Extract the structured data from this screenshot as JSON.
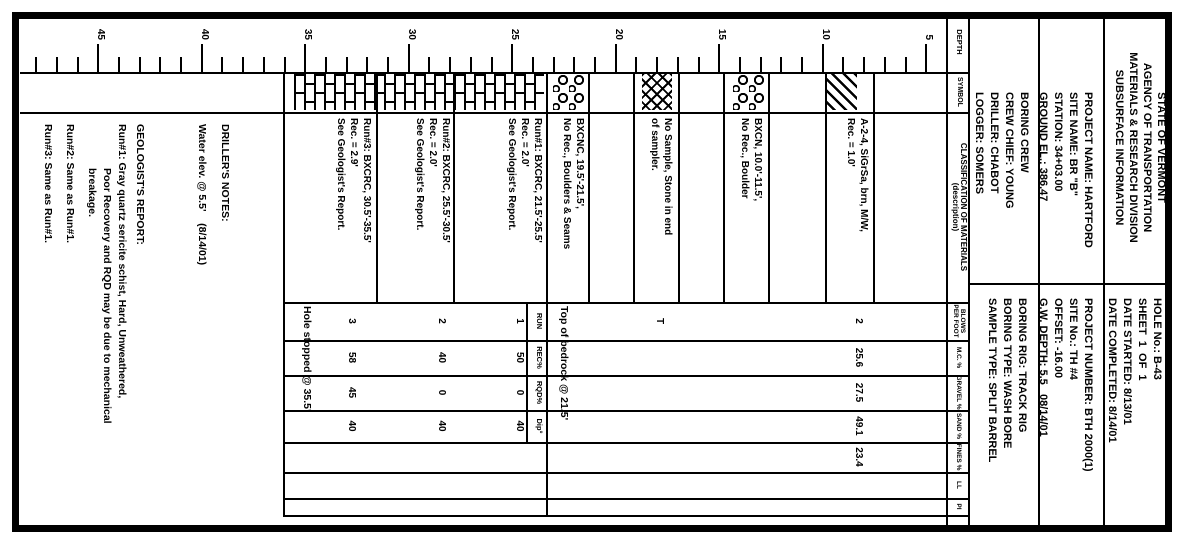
{
  "colors": {
    "ink": "#000000",
    "paper": "#ffffff"
  },
  "header": {
    "title_lines": [
      "STATE OF VERMONT",
      "AGENCY OF TRANSPORTATION",
      "MATERIALS & RESEARCH DIVISION",
      "SUBSURFACE INFORMATION"
    ],
    "hole_lines": [
      "HOLE No.: B-43",
      "SHEET  1  OF  1",
      "DATE STARTED: 8/13/01",
      "DATE COMPLETED: 8/14/01"
    ],
    "project_left_lines": [
      "PROJECT NAME: HARTFORD",
      "SITE NAME: BR \"B\"",
      "STATION: 34+03.00",
      "GROUND EL.: 386.47"
    ],
    "project_right_lines": [
      "PROJECT NUMBER: BTH 2000(1)",
      "SITE No.: TH #4",
      "OFFSET: -16.00",
      "G.W. DEPTH: 5.5   08/14/01"
    ],
    "crew_left_lines": [
      "BORING CREW",
      "CREW CHIEF: YOUNG",
      "DRILLER: CHABOT",
      "LOGGER: SOMERS"
    ],
    "crew_right_lines": [
      "BORING RIG: TRACK RIG",
      "BORING TYPE: WASH BORE",
      "SAMPLE TYPE: SPLIT BARREL"
    ]
  },
  "columns": {
    "depth": "DEPTH",
    "symbol": "SYMBOL",
    "classification": "CLASSIFICATION OF MATERIALS",
    "classification_sub": "(description)",
    "data": [
      "BLOWS PER FOOT",
      "M.C. %",
      "GRAVEL %",
      "SAND %",
      "FINES %",
      "LL",
      "PI"
    ]
  },
  "log": {
    "depth_scale": {
      "min": 4,
      "max": 48,
      "top": 236,
      "bottom": 1158,
      "px_per_ft": 20.7,
      "major_every": 5,
      "label_min": 5,
      "label_max": 45
    },
    "data_columns": [
      {
        "x": 302,
        "w": 38
      },
      {
        "x": 340,
        "w": 35
      },
      {
        "x": 375,
        "w": 35
      },
      {
        "x": 410,
        "w": 32
      },
      {
        "x": 442,
        "w": 30
      },
      {
        "x": 472,
        "w": 26
      },
      {
        "x": 498,
        "w": 17
      }
    ],
    "lines": [
      {
        "x": 283,
        "y": 12,
        "w": 2,
        "h": 202
      },
      {
        "x": 12,
        "y": 79,
        "w": 520,
        "h": 2
      },
      {
        "x": 12,
        "y": 144,
        "w": 520,
        "h": 2
      },
      {
        "x": 12,
        "y": 214,
        "w": 520,
        "h": 2
      },
      {
        "x": 12,
        "y": 236,
        "w": 520,
        "h": 2
      },
      {
        "x": 72,
        "y": 214,
        "w": 2,
        "h": 950
      },
      {
        "x": 112,
        "y": 214,
        "w": 2,
        "h": 950
      },
      {
        "x": 302,
        "y": 214,
        "w": 2,
        "h": 687
      },
      {
        "x": 340,
        "y": 214,
        "w": 2,
        "h": 687
      },
      {
        "x": 375,
        "y": 214,
        "w": 2,
        "h": 687
      },
      {
        "x": 410,
        "y": 214,
        "w": 2,
        "h": 687
      },
      {
        "x": 442,
        "y": 214,
        "w": 2,
        "h": 687
      },
      {
        "x": 472,
        "y": 214,
        "w": 2,
        "h": 687
      },
      {
        "x": 498,
        "y": 214,
        "w": 2,
        "h": 687
      },
      {
        "x": 515,
        "y": 214,
        "w": 2,
        "h": 687
      },
      {
        "x": 72,
        "y": 309,
        "w": 230,
        "h": 2
      },
      {
        "x": 72,
        "y": 357,
        "w": 230,
        "h": 2
      },
      {
        "x": 72,
        "y": 414,
        "w": 230,
        "h": 2
      },
      {
        "x": 72,
        "y": 459,
        "w": 230,
        "h": 2
      },
      {
        "x": 72,
        "y": 504,
        "w": 230,
        "h": 2
      },
      {
        "x": 72,
        "y": 549,
        "w": 230,
        "h": 2
      },
      {
        "x": 72,
        "y": 594,
        "w": 230,
        "h": 2
      },
      {
        "x": 72,
        "y": 636,
        "w": 445,
        "h": 2
      },
      {
        "x": 302,
        "y": 656,
        "w": 140,
        "h": 2
      },
      {
        "x": 72,
        "y": 729,
        "w": 230,
        "h": 2
      },
      {
        "x": 72,
        "y": 806,
        "w": 230,
        "h": 2
      },
      {
        "x": 72,
        "y": 899,
        "w": 445,
        "h": 2
      }
    ],
    "symbols": [
      {
        "pattern": "diag",
        "y": 327,
        "h": 30
      },
      {
        "pattern": "boulders",
        "y": 419,
        "h": 32
      },
      {
        "pattern": "cross",
        "y": 512,
        "h": 30
      },
      {
        "pattern": "boulders",
        "y": 599,
        "h": 32
      },
      {
        "pattern": "brick",
        "y": 640,
        "h": 257
      }
    ],
    "descriptions": [
      {
        "y": 314,
        "lines": [
          "A-2-4, SiGrSa, brn, M/W,",
          "Rec. = 1.0'"
        ]
      },
      {
        "y": 420,
        "lines": [
          "BXCN, 10.0'-11.5',",
          "No Rec., Boulder"
        ]
      },
      {
        "y": 510,
        "lines": [
          "No Sample, Stone in end",
          "of sampler."
        ]
      },
      {
        "y": 598,
        "lines": [
          "BXCNC, 19.5'-21.5',",
          "No Rec., Boulders & Seams"
        ]
      },
      {
        "y": 640,
        "lines": [
          "Run#1: BXCRC, 21.5'-25.5'",
          "Rec. = 2.0'",
          "See Geologist's Report."
        ]
      },
      {
        "y": 732,
        "lines": [
          "Run#2: BXCRC, 25.5'-30.5'",
          "Rec. = 2.0'",
          "See Geologist's Report."
        ]
      },
      {
        "y": 811,
        "lines": [
          "Run#3: BXCRC, 30.5'-35.5'",
          "Rec. = 2.9'",
          "See Geologist's Report."
        ]
      }
    ],
    "data_rows": [
      {
        "y": 320,
        "small": false,
        "values": [
          "2",
          "25.6",
          "27.5",
          "49.1",
          "23.4",
          "",
          ""
        ]
      },
      {
        "y": 519,
        "small": false,
        "values": [
          "T",
          "",
          "",
          "",
          "",
          "",
          ""
        ]
      },
      {
        "y": 640,
        "small": true,
        "values": [
          "RUN",
          "REC%",
          "RQD%",
          "Dip°",
          "",
          "",
          ""
        ]
      },
      {
        "y": 659,
        "small": false,
        "values": [
          "1",
          "50",
          "0",
          "40",
          "",
          "",
          ""
        ]
      },
      {
        "y": 737,
        "small": false,
        "values": [
          "2",
          "40",
          "0",
          "40",
          "",
          "",
          ""
        ]
      },
      {
        "y": 827,
        "small": false,
        "values": [
          "3",
          "58",
          "45",
          "40",
          "",
          "",
          ""
        ]
      }
    ],
    "annotations": [
      {
        "x": 306,
        "y": 614,
        "text": "Top of bedrock @ 21.5'"
      },
      {
        "x": 306,
        "y": 871,
        "text": "Hole stopped @ 35.5'"
      },
      {
        "x": 124,
        "y": 953,
        "text": "DRILLER'S NOTES:"
      },
      {
        "x": 124,
        "y": 976,
        "text": "Water elev. @ 5.5'    (8/14/01)"
      },
      {
        "x": 124,
        "y": 1038,
        "text": "GEOLOGIST'S REPORT:"
      },
      {
        "x": 124,
        "y": 1056,
        "text": "Run#1: Gray quartz sericite schist, Hard, Unweathered,"
      },
      {
        "x": 168,
        "y": 1071,
        "text": "Poor Recovery and RQD may be due to mechanical"
      },
      {
        "x": 168,
        "y": 1086,
        "text": "breakage."
      },
      {
        "x": 124,
        "y": 1108,
        "text": "Run#2: Same as Run#1."
      },
      {
        "x": 124,
        "y": 1130,
        "text": "Run#3: Same as Run#1."
      }
    ]
  }
}
